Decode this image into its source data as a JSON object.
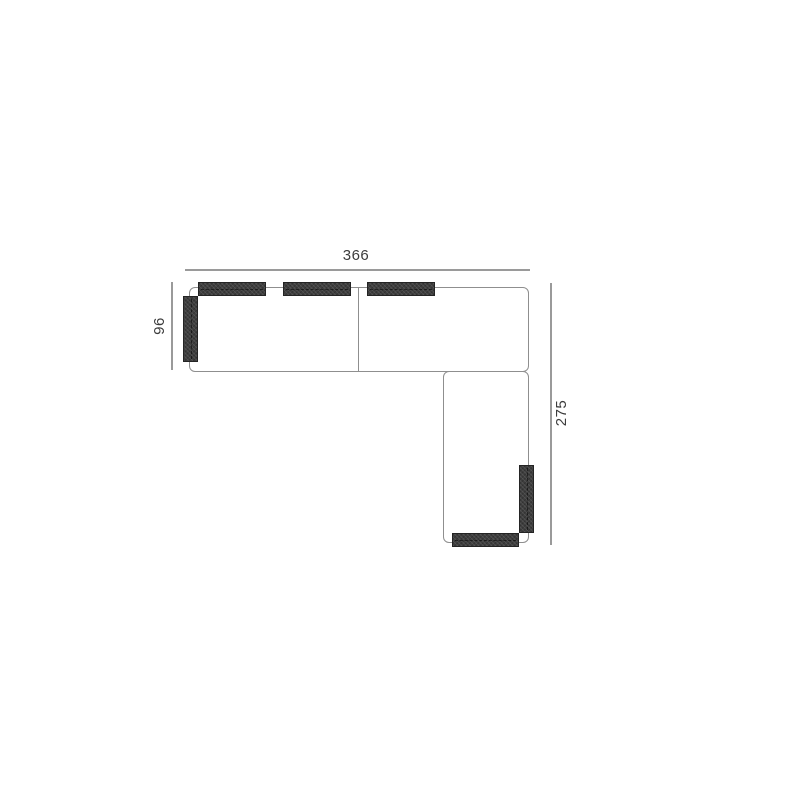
{
  "diagram": {
    "type": "sofa-sectional-top-view-dimension-drawing",
    "dimensions": {
      "width_label": "366",
      "left_depth_label": "96",
      "right_depth_label": "275"
    },
    "parts": {
      "body_sections": 2,
      "back_cushions": 3,
      "left_armrest": 1,
      "chaise_side_cushion": 1,
      "chaise_end_cushion": 1
    },
    "colors": {
      "outline": "#8f8f8f",
      "dimension_line": "#9a9a9a",
      "cushion_fill": "#3e3e3e",
      "cushion_border": "#242424",
      "label_text": "#3c3c3c",
      "background": "#ffffff"
    }
  }
}
